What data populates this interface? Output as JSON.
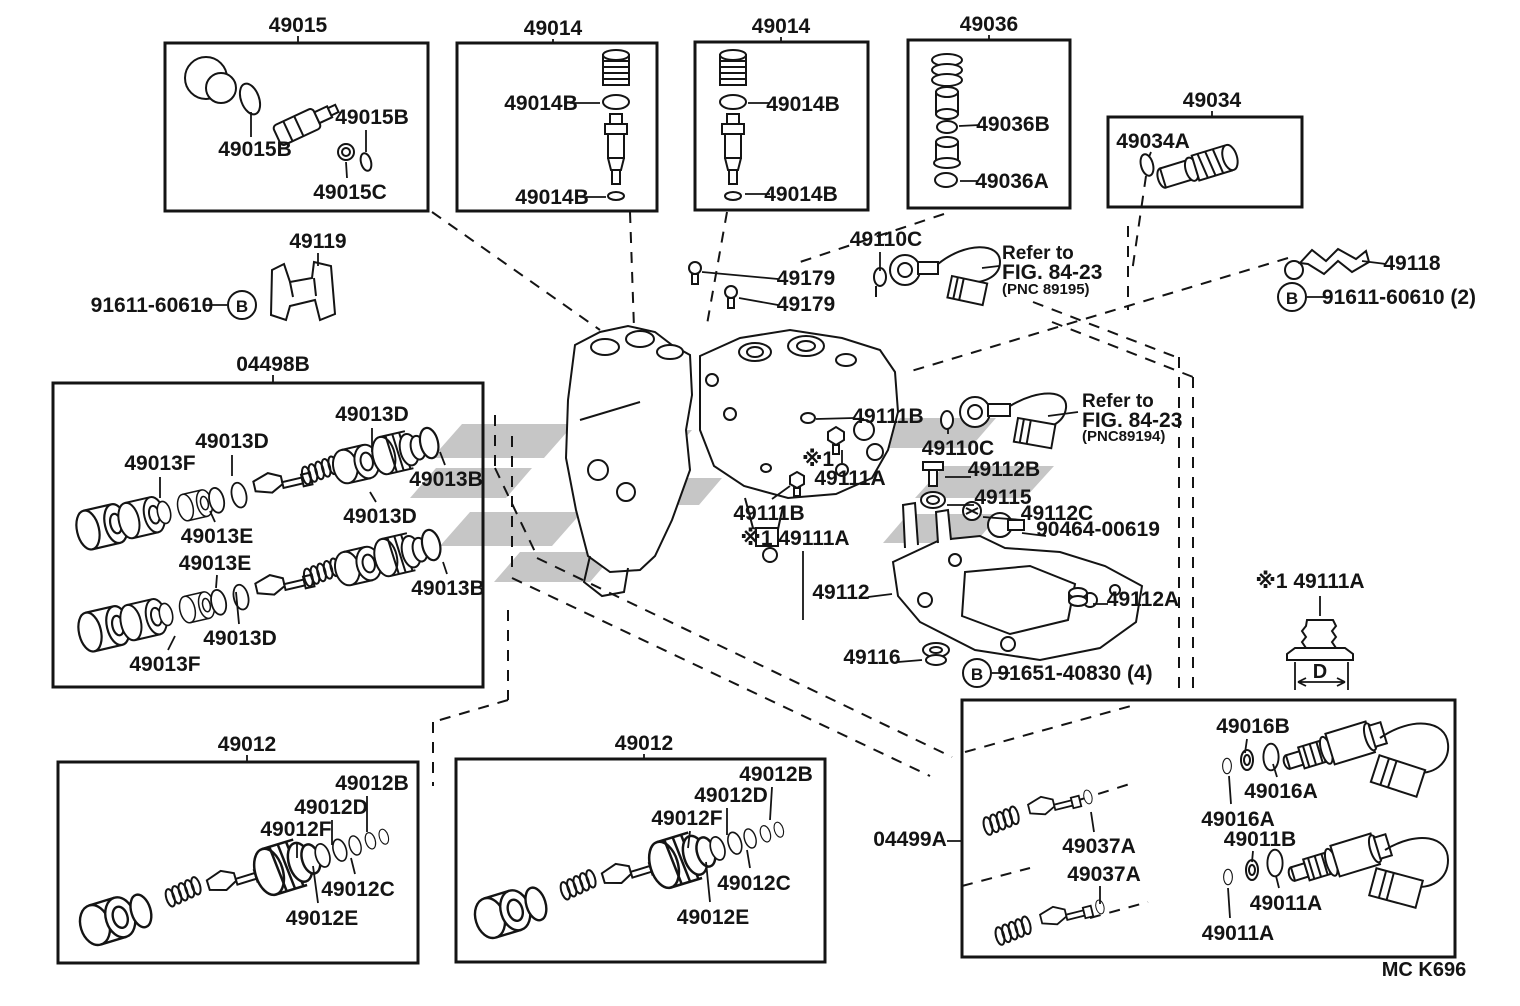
{
  "diagram": {
    "type": "exploded-parts-diagram",
    "code": "MC K696",
    "line_color": "#141414",
    "watermark_color": "#c6c6c6",
    "background": "#ffffff"
  },
  "circled": [
    {
      "letter": "B"
    },
    {
      "letter": "B"
    },
    {
      "letter": "B"
    }
  ],
  "labels": [
    {
      "t": "49015",
      "x": 298,
      "y": 32
    },
    {
      "t": "49014",
      "x": 553,
      "y": 35
    },
    {
      "t": "49014",
      "x": 781,
      "y": 33
    },
    {
      "t": "49036",
      "x": 989,
      "y": 31
    },
    {
      "t": "49034",
      "x": 1212,
      "y": 107
    },
    {
      "t": "49015B",
      "x": 372,
      "y": 124
    },
    {
      "t": "49015B",
      "x": 255,
      "y": 156
    },
    {
      "t": "49015C",
      "x": 350,
      "y": 199
    },
    {
      "t": "49014B",
      "x": 541,
      "y": 110
    },
    {
      "t": "49014B",
      "x": 552,
      "y": 204
    },
    {
      "t": "49014B",
      "x": 803,
      "y": 111
    },
    {
      "t": "49014B",
      "x": 801,
      "y": 201
    },
    {
      "t": "49036B",
      "x": 1013,
      "y": 131
    },
    {
      "t": "49036A",
      "x": 1012,
      "y": 188
    },
    {
      "t": "49034A",
      "x": 1153,
      "y": 148
    },
    {
      "t": "49119",
      "x": 318,
      "y": 248
    },
    {
      "t": "91611-60610",
      "x": 152,
      "y": 312
    },
    {
      "t": "04498B",
      "x": 273,
      "y": 371
    },
    {
      "t": "49013D",
      "x": 372,
      "y": 421
    },
    {
      "t": "49013D",
      "x": 232,
      "y": 448
    },
    {
      "t": "49013F",
      "x": 160,
      "y": 470
    },
    {
      "t": "49013B",
      "x": 446,
      "y": 486
    },
    {
      "t": "49013D",
      "x": 380,
      "y": 523
    },
    {
      "t": "49013E",
      "x": 217,
      "y": 543
    },
    {
      "t": "49013E",
      "x": 215,
      "y": 570
    },
    {
      "t": "49013B",
      "x": 448,
      "y": 595
    },
    {
      "t": "49013D",
      "x": 240,
      "y": 645
    },
    {
      "t": "49013F",
      "x": 165,
      "y": 671
    },
    {
      "t": "49179",
      "x": 806,
      "y": 285
    },
    {
      "t": "49179",
      "x": 806,
      "y": 311
    },
    {
      "t": "49110C",
      "x": 886,
      "y": 246
    },
    {
      "t": "Refer to",
      "x": 1002,
      "y": 259,
      "s": 19,
      "a": "start"
    },
    {
      "t": "FIG. 84-23",
      "x": 1002,
      "y": 279,
      "s": 21,
      "a": "start"
    },
    {
      "t": "(PNC 89195)",
      "x": 1002,
      "y": 294,
      "s": 15,
      "a": "start"
    },
    {
      "t": "49118",
      "x": 1412,
      "y": 270
    },
    {
      "t": "91611-60610 (2)",
      "x": 1399,
      "y": 304
    },
    {
      "t": "49111B",
      "x": 888,
      "y": 423
    },
    {
      "t": "※1",
      "x": 818,
      "y": 466
    },
    {
      "t": "49111A",
      "x": 850,
      "y": 485
    },
    {
      "t": "49110C",
      "x": 958,
      "y": 455
    },
    {
      "t": "49112B",
      "x": 1004,
      "y": 476
    },
    {
      "t": "49115",
      "x": 1003,
      "y": 504
    },
    {
      "t": "49112C",
      "x": 1057,
      "y": 520
    },
    {
      "t": "90464-00619",
      "x": 1098,
      "y": 536
    },
    {
      "t": "Refer to",
      "x": 1082,
      "y": 407,
      "s": 19,
      "a": "start"
    },
    {
      "t": "FIG. 84-23",
      "x": 1082,
      "y": 427,
      "s": 21,
      "a": "start"
    },
    {
      "t": "(PNC89194)",
      "x": 1082,
      "y": 441,
      "s": 15,
      "a": "start"
    },
    {
      "t": "49111B",
      "x": 769,
      "y": 520
    },
    {
      "t": "※1 49111A",
      "x": 795,
      "y": 545
    },
    {
      "t": "49112",
      "x": 841,
      "y": 599
    },
    {
      "t": "49112A",
      "x": 1143,
      "y": 606
    },
    {
      "t": "49116",
      "x": 872,
      "y": 664
    },
    {
      "t": "91651-40830 (4)",
      "x": 1075,
      "y": 680
    },
    {
      "t": "※1 49111A",
      "x": 1310,
      "y": 588
    },
    {
      "t": "D",
      "x": 1320,
      "y": 678,
      "s": 20
    },
    {
      "t": "49012",
      "x": 247,
      "y": 751
    },
    {
      "t": "49012B",
      "x": 372,
      "y": 790
    },
    {
      "t": "49012D",
      "x": 331,
      "y": 814
    },
    {
      "t": "49012F",
      "x": 296,
      "y": 836
    },
    {
      "t": "49012C",
      "x": 358,
      "y": 896
    },
    {
      "t": "49012E",
      "x": 322,
      "y": 925
    },
    {
      "t": "49012",
      "x": 644,
      "y": 750
    },
    {
      "t": "49012B",
      "x": 776,
      "y": 781
    },
    {
      "t": "49012D",
      "x": 731,
      "y": 802
    },
    {
      "t": "49012F",
      "x": 687,
      "y": 825
    },
    {
      "t": "49012C",
      "x": 754,
      "y": 890
    },
    {
      "t": "49012E",
      "x": 713,
      "y": 924
    },
    {
      "t": "04499A",
      "x": 910,
      "y": 846
    },
    {
      "t": "49016B",
      "x": 1253,
      "y": 733
    },
    {
      "t": "49016A",
      "x": 1281,
      "y": 798
    },
    {
      "t": "49016A",
      "x": 1238,
      "y": 826
    },
    {
      "t": "49011B",
      "x": 1260,
      "y": 846
    },
    {
      "t": "49011A",
      "x": 1286,
      "y": 910
    },
    {
      "t": "49011A",
      "x": 1238,
      "y": 940
    },
    {
      "t": "49037A",
      "x": 1099,
      "y": 853
    },
    {
      "t": "49037A",
      "x": 1104,
      "y": 881
    },
    {
      "t": "MC K696",
      "x": 1424,
      "y": 976,
      "s": 20
    }
  ]
}
